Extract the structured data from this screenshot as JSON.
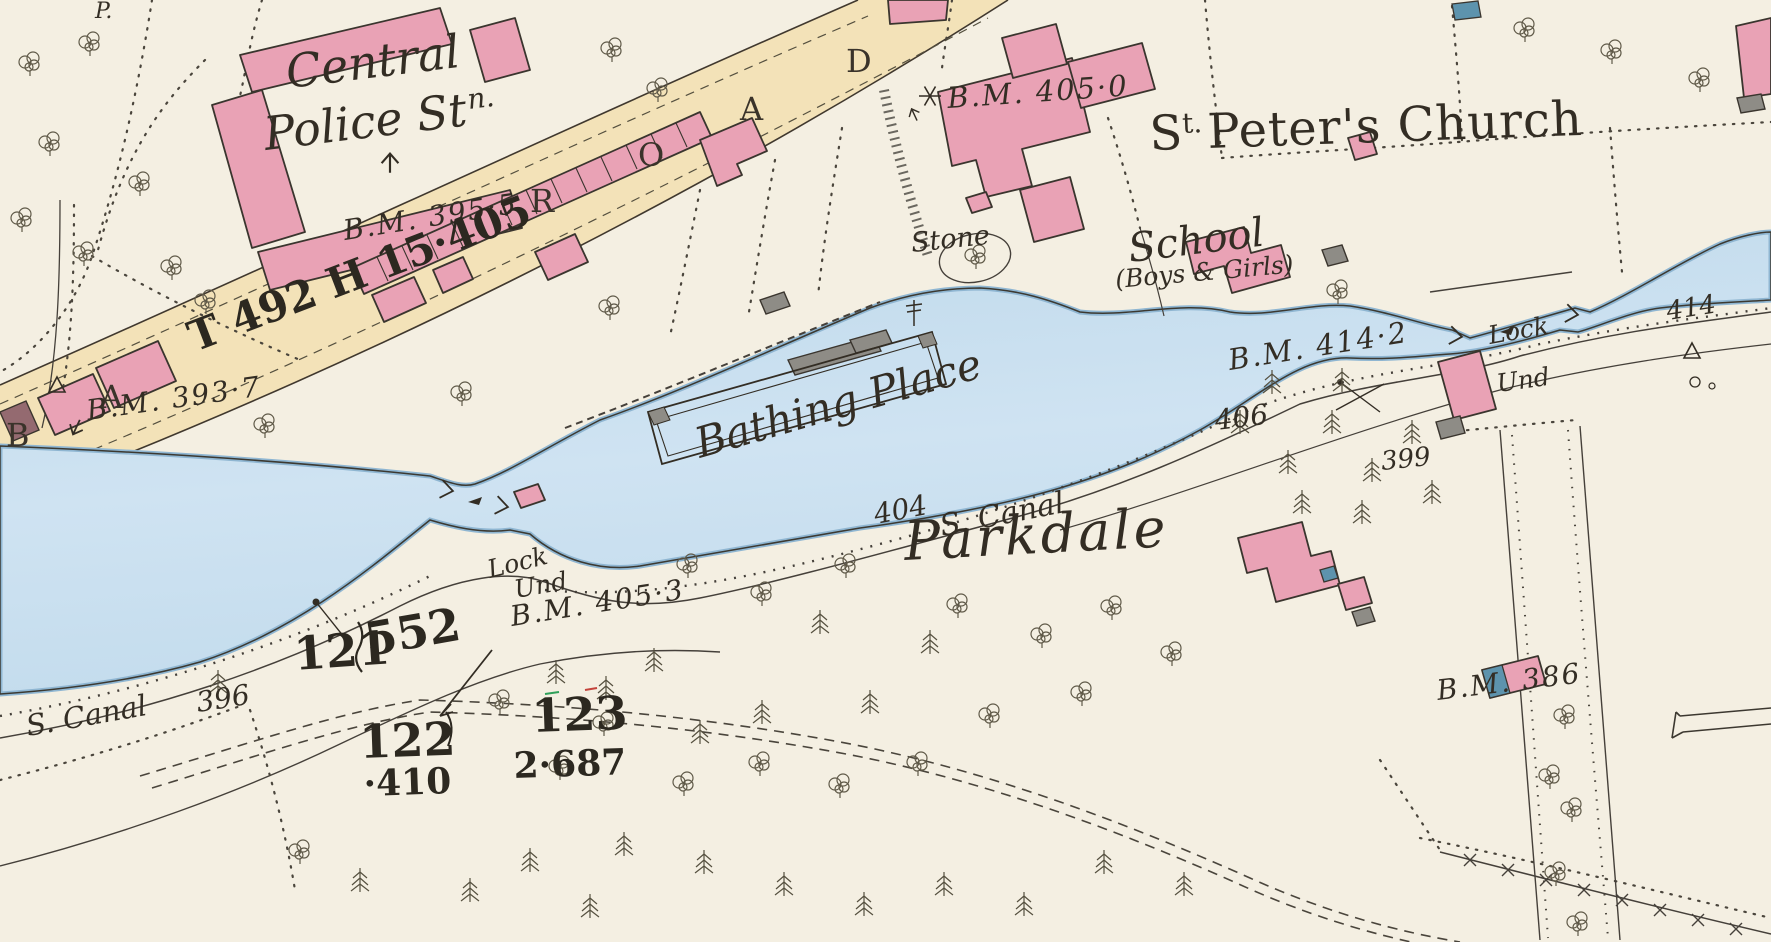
{
  "map": {
    "labels": {
      "p_corner": "P.",
      "police_line1": "Central",
      "police_line2": "Police St",
      "police_sup": "n.",
      "bm_395_5": "B.M. 395·5",
      "road_parcel": "T 492 H 15·405",
      "bm_393_7": "B.M. 393·7",
      "bm_405_0": "B.M. 405·0",
      "church_initial": "S",
      "church_sup": "t.",
      "church_rest": "Peter's Church",
      "stone": "Stone",
      "school": "School",
      "school_sub": "(Boys & Girls)",
      "bathing_place": "Bathing Place",
      "bm_414_2": "B.M. 414·2",
      "lock_right": "Lock",
      "und_right": "Und",
      "spot_414": "414",
      "spot_406": "406",
      "spot_404": "404",
      "canal_mid": "S. Canal",
      "parkdale": "Parkdale",
      "lock_left": "Lock",
      "und_left": "Und",
      "bm_405_3": "B.M. 405·3",
      "parcel_121": "121",
      "parcel_121_area": "552",
      "parcel_122": "122",
      "parcel_122_area": "·410",
      "parcel_123": "123",
      "parcel_123_area": "2·687",
      "canal_left": "S. Canal",
      "spot_396": "396",
      "spot_399": "399",
      "bm_386": "B.M. 386"
    },
    "road_letters": [
      "B",
      "A",
      "R",
      "O",
      "A",
      "D"
    ],
    "colors": {
      "paper": "#f4efe2",
      "water": "#c9dff0",
      "road": "#f3e2b8",
      "building_pink": "#e9a2b5",
      "building_gray": "#8e8c86",
      "building_slate": "#5d93ad",
      "ink": "#332d24"
    }
  }
}
